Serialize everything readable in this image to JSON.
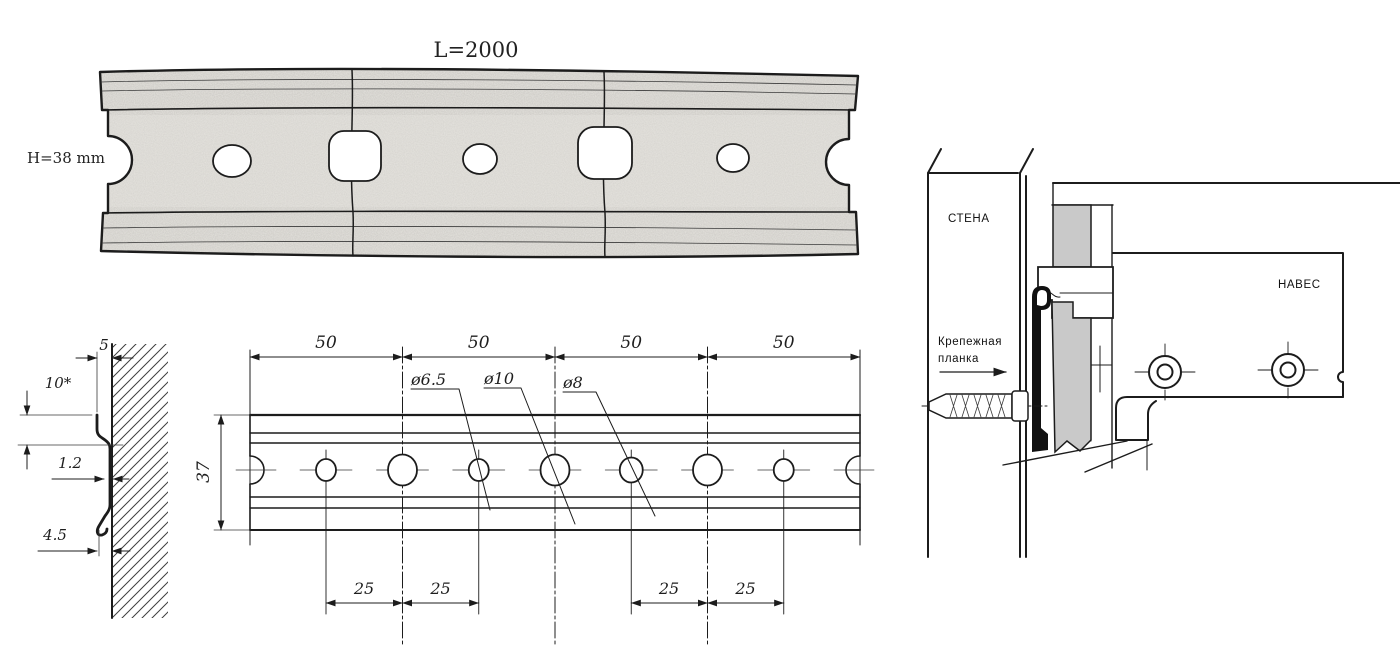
{
  "colors": {
    "ink": "#1c1c1c",
    "panel_gray": "#c9c9c9",
    "rail_texture": "#e7e5e0"
  },
  "photo_view": {
    "length_label": "L=2000",
    "height_label": "H=38 mm"
  },
  "profile_view": {
    "top_width": "5",
    "hook_height": "10*",
    "thickness": "1.2",
    "bottom_offset": "4.5"
  },
  "plan_view": {
    "pitch_labels": [
      "50",
      "50",
      "50",
      "50"
    ],
    "half_pitch_labels": [
      "25",
      "25",
      "25",
      "25"
    ],
    "height": "37",
    "dia_small": "ø6.5",
    "dia_large": "ø10",
    "dia_mid": "ø8"
  },
  "install_view": {
    "wall": "СТЕНА",
    "cabinet": "НАВЕС",
    "strip_line1": "Крепежная",
    "strip_line2": "планка"
  }
}
